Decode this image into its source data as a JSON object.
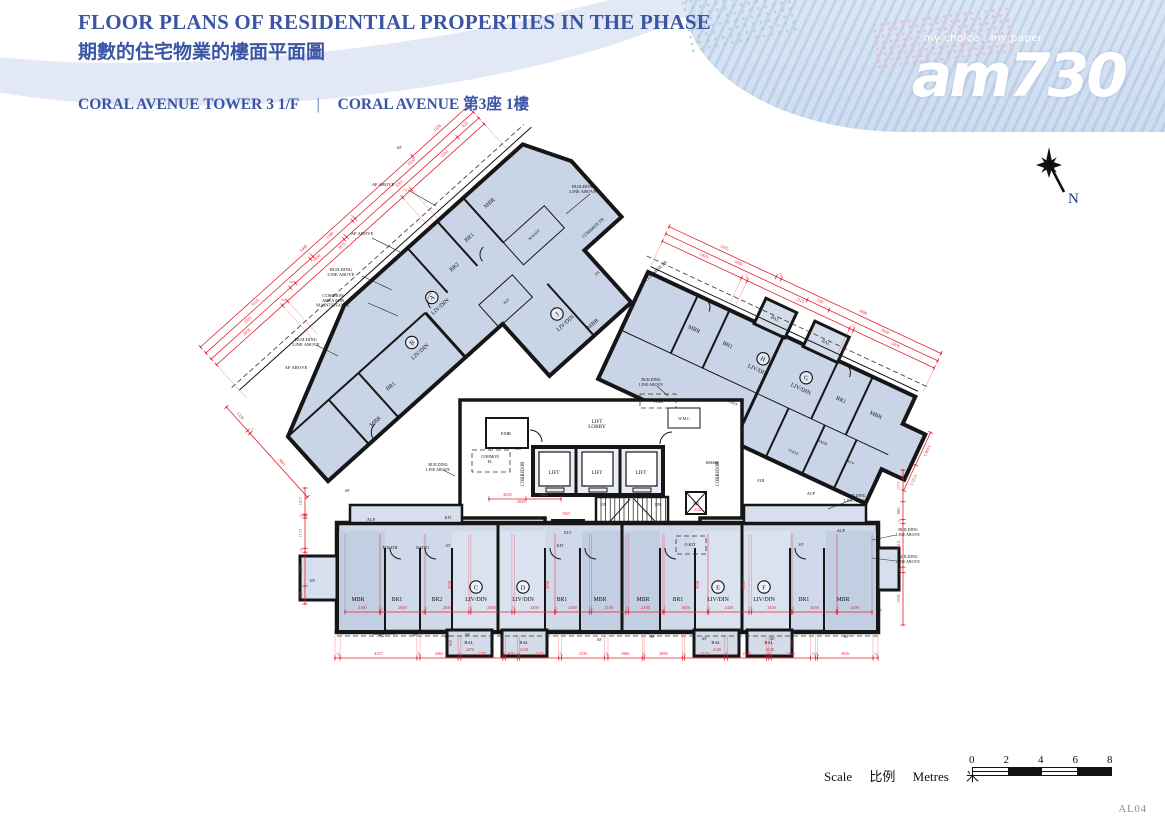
{
  "theme": {
    "accent": "#3a55a4",
    "red": "#e5202e",
    "wall": "#161616",
    "unit_fill": "#c9d4e6"
  },
  "header": {
    "title_en": "FLOOR PLANS OF RESIDENTIAL PROPERTIES IN THE PHASE",
    "title_zh": "期數的住宅物業的樓面平面圖",
    "subtitle_en": "CORAL AVENUE TOWER 3  1/F",
    "separator": "|",
    "subtitle_name": "CORAL AVENUE",
    "subtitle_zh": "第3座 1樓"
  },
  "logo": {
    "tagline": "my choice : my paper",
    "name": "am730"
  },
  "compass": {
    "n": "N"
  },
  "scalebar": {
    "scale_en": "Scale",
    "scale_zh": "比例",
    "metres_en": "Metres",
    "metres_zh": "米",
    "ticks": [
      "0",
      "2",
      "4",
      "6",
      "8"
    ]
  },
  "footer": {
    "code": "AL04"
  },
  "plan": {
    "labels": [
      {
        "t": "C",
        "x": 476,
        "y": 587,
        "c": "circ"
      },
      {
        "t": "D",
        "x": 523,
        "y": 587,
        "c": "circ"
      },
      {
        "t": "E",
        "x": 718,
        "y": 587,
        "c": "circ"
      },
      {
        "t": "F",
        "x": 764,
        "y": 587,
        "c": "circ"
      },
      {
        "t": "MBR",
        "x": 358,
        "y": 601,
        "c": "room"
      },
      {
        "t": "BR1",
        "x": 397,
        "y": 601,
        "c": "room"
      },
      {
        "t": "BR2",
        "x": 437,
        "y": 601,
        "c": "room"
      },
      {
        "t": "LIV/DIN",
        "x": 476,
        "y": 601,
        "c": "room"
      },
      {
        "t": "LIV/DIN",
        "x": 523,
        "y": 601,
        "c": "room"
      },
      {
        "t": "BR1",
        "x": 562,
        "y": 601,
        "c": "room"
      },
      {
        "t": "MBR",
        "x": 600,
        "y": 601,
        "c": "room"
      },
      {
        "t": "MBR",
        "x": 643,
        "y": 601,
        "c": "room"
      },
      {
        "t": "BR1",
        "x": 678,
        "y": 601,
        "c": "room"
      },
      {
        "t": "LIV/DIN",
        "x": 718,
        "y": 601,
        "c": "room"
      },
      {
        "t": "LIV/DIN",
        "x": 764,
        "y": 601,
        "c": "room"
      },
      {
        "t": "BR1",
        "x": 804,
        "y": 601,
        "c": "room"
      },
      {
        "t": "MBR",
        "x": 843,
        "y": 601,
        "c": "room"
      },
      {
        "t": "BAL",
        "x": 469,
        "y": 644,
        "c": "sm",
        "s": 4.6
      },
      {
        "t": "BAL",
        "x": 524,
        "y": 644,
        "c": "sm",
        "s": 4.6
      },
      {
        "t": "BAL",
        "x": 716,
        "y": 644,
        "c": "sm",
        "s": 4.6
      },
      {
        "t": "BAL",
        "x": 769,
        "y": 644,
        "c": "sm",
        "s": 4.6
      },
      {
        "t": "UP",
        "x": 312,
        "y": 582,
        "c": "sm"
      },
      {
        "t": "LIFT",
        "x": 554,
        "y": 474,
        "c": "room",
        "s": 5.2
      },
      {
        "t": "LIFT",
        "x": 597,
        "y": 474,
        "c": "room",
        "s": 5.2
      },
      {
        "t": "LIFT",
        "x": 641,
        "y": 474,
        "c": "room",
        "s": 5.2
      },
      {
        "t": "LIFT\nLOBBY",
        "x": 597,
        "y": 423,
        "c": "room",
        "s": 5.2
      },
      {
        "t": "CORRIDOR",
        "x": 524,
        "y": 474,
        "c": "sm",
        "s": 4.8,
        "r": -90
      },
      {
        "t": "CORRIDOR",
        "x": 719,
        "y": 474,
        "c": "sm",
        "s": 4.8,
        "r": -90
      },
      {
        "t": "EMR",
        "x": 506,
        "y": 435,
        "c": "sm",
        "s": 4.6
      },
      {
        "t": "COMMON\nEL",
        "x": 490,
        "y": 458,
        "c": "sm",
        "s": 3.9
      },
      {
        "t": "ELV",
        "x": 568,
        "y": 534,
        "c": "sm",
        "s": 4.2
      },
      {
        "t": "UP",
        "x": 603,
        "y": 506,
        "c": "sm",
        "s": 4.2
      },
      {
        "t": "DN",
        "x": 658,
        "y": 506,
        "c": "sm",
        "s": 4.2
      },
      {
        "t": "PD",
        "x": 696,
        "y": 505,
        "c": "sm",
        "s": 4.4
      },
      {
        "t": "RS&MR",
        "x": 712,
        "y": 464,
        "c": "sm",
        "s": 3.6
      },
      {
        "t": "ELR",
        "x": 761,
        "y": 482,
        "c": "sm",
        "s": 3.8
      },
      {
        "t": "W.M.C",
        "x": 684,
        "y": 420,
        "c": "sm",
        "s": 4
      },
      {
        "t": "VOID",
        "x": 658,
        "y": 403,
        "c": "sm",
        "s": 4.2
      },
      {
        "t": "DH",
        "x": 518,
        "y": 450,
        "c": "sm",
        "s": 3.8
      },
      {
        "t": "ACP",
        "x": 371,
        "y": 521,
        "c": "sm"
      },
      {
        "t": "KIT",
        "x": 448,
        "y": 519,
        "c": "sm"
      },
      {
        "t": "M.BATH",
        "x": 390,
        "y": 549,
        "c": "sm",
        "s": 4
      },
      {
        "t": "BATH 1",
        "x": 423,
        "y": 549,
        "c": "sm",
        "s": 4
      },
      {
        "t": "ST",
        "x": 448,
        "y": 547,
        "c": "sm",
        "s": 4
      },
      {
        "t": "KIT",
        "x": 560,
        "y": 547,
        "c": "sm"
      },
      {
        "t": "O.KIT",
        "x": 690,
        "y": 546,
        "c": "sm"
      },
      {
        "t": "ST",
        "x": 801,
        "y": 546,
        "c": "sm"
      },
      {
        "t": "ACP",
        "x": 841,
        "y": 532,
        "c": "sm"
      },
      {
        "t": "ACP",
        "x": 811,
        "y": 495,
        "c": "sm"
      },
      {
        "t": "AF",
        "x": 399,
        "y": 149,
        "c": "ann",
        "s": 4
      },
      {
        "t": "AF ABOVE",
        "x": 383,
        "y": 186,
        "c": "ann"
      },
      {
        "t": "AF ABOVE",
        "x": 362,
        "y": 235,
        "c": "ann"
      },
      {
        "t": "BUILDING\nLINE ABOVE",
        "x": 341,
        "y": 271,
        "c": "ann"
      },
      {
        "t": "COMMON\nAREA FOR\nMAINTENANCE",
        "x": 333,
        "y": 297,
        "c": "ann"
      },
      {
        "t": "BUILDING\nLINE ABOVE",
        "x": 306,
        "y": 341,
        "c": "ann"
      },
      {
        "t": "AF ABOVE",
        "x": 296,
        "y": 369,
        "c": "ann"
      },
      {
        "t": "BUILDING\nLINE ABOVE",
        "x": 583,
        "y": 188,
        "c": "ann"
      },
      {
        "t": "COMMON FR",
        "x": 594,
        "y": 229,
        "c": "ann",
        "r": -42
      },
      {
        "t": "COMMON FR",
        "x": 657,
        "y": 272,
        "c": "ann",
        "r": -42
      },
      {
        "t": "BUILDING\nLINE ABOVE",
        "x": 651,
        "y": 381,
        "c": "ann",
        "s": 4
      },
      {
        "t": "BUILDING\nLINE ABOVE",
        "x": 438,
        "y": 466,
        "c": "ann",
        "s": 4
      },
      {
        "t": "BUILDING\nLINE ABOVE",
        "x": 856,
        "y": 497,
        "c": "ann",
        "s": 4
      },
      {
        "t": "BUILDING\nLINE ABOVE",
        "x": 908,
        "y": 531,
        "c": "ann",
        "s": 4
      },
      {
        "t": "BUILDING\nLINE ABOVE",
        "x": 908,
        "y": 558,
        "c": "ann",
        "s": 4
      },
      {
        "t": "AF ABOVE",
        "x": 384,
        "y": 635,
        "c": "ann"
      },
      {
        "t": "AF",
        "x": 336,
        "y": 633,
        "c": "ann",
        "s": 4
      },
      {
        "t": "AF",
        "x": 415,
        "y": 636,
        "c": "ann",
        "s": 4
      },
      {
        "t": "AF",
        "x": 447,
        "y": 638,
        "c": "ann",
        "s": 4
      },
      {
        "t": "AF",
        "x": 467,
        "y": 636,
        "c": "ann",
        "s": 4
      },
      {
        "t": "AF",
        "x": 599,
        "y": 641,
        "c": "ann",
        "s": 4
      },
      {
        "t": "AF",
        "x": 652,
        "y": 638,
        "c": "ann",
        "s": 4
      },
      {
        "t": "AF",
        "x": 704,
        "y": 640,
        "c": "ann",
        "s": 4
      },
      {
        "t": "AF",
        "x": 772,
        "y": 640,
        "c": "ann",
        "s": 4
      },
      {
        "t": "AF",
        "x": 846,
        "y": 638,
        "c": "ann",
        "s": 4
      },
      {
        "t": "AF",
        "x": 305,
        "y": 517,
        "c": "ann",
        "s": 4
      },
      {
        "t": "AF",
        "x": 347,
        "y": 492,
        "c": "ann",
        "s": 4
      },
      {
        "t": "AF",
        "x": 879,
        "y": 612,
        "c": "ann",
        "s": 4
      },
      {
        "t": "2470",
        "x": 470,
        "y": 651,
        "c": "red"
      },
      {
        "t": "2120",
        "x": 524,
        "y": 651,
        "c": "red"
      },
      {
        "t": "2120",
        "x": 717,
        "y": 651,
        "c": "red"
      },
      {
        "t": "2126",
        "x": 770,
        "y": 651,
        "c": "red"
      },
      {
        "t": "2035",
        "x": 521,
        "y": 503,
        "c": "red"
      },
      {
        "t": "1925",
        "x": 566,
        "y": 515,
        "c": "red"
      },
      {
        "t": "2128",
        "x": 698,
        "y": 511,
        "c": "red"
      },
      {
        "t": "3150",
        "x": 451,
        "y": 585,
        "c": "vred"
      },
      {
        "t": "3150",
        "x": 549,
        "y": 585,
        "c": "vred"
      },
      {
        "t": "3150",
        "x": 699,
        "y": 585,
        "c": "vred"
      },
      {
        "t": "3150",
        "x": 745,
        "y": 585,
        "c": "vred"
      },
      {
        "t": "850",
        "x": 452,
        "y": 643,
        "c": "vred"
      },
      {
        "t": "850",
        "x": 794,
        "y": 643,
        "c": "vred"
      },
      {
        "g": "ab",
        "t": "A",
        "x": 518,
        "y": 418,
        "c": "circ"
      },
      {
        "g": "ab",
        "t": "LIV/DIN",
        "x": 518,
        "y": 432,
        "c": "room"
      },
      {
        "g": "ab",
        "t": "MBR",
        "x": 624,
        "y": 388,
        "c": "room"
      },
      {
        "g": "ab",
        "t": "BR1",
        "x": 586,
        "y": 400,
        "c": "room"
      },
      {
        "g": "ab",
        "t": "BR2",
        "x": 555,
        "y": 412,
        "c": "room"
      },
      {
        "g": "ab",
        "t": "M.BATH",
        "x": 636,
        "y": 441,
        "c": "sm",
        "s": 3.8
      },
      {
        "g": "ab",
        "t": "KIT",
        "x": 571,
        "y": 472,
        "c": "sm",
        "s": 4
      },
      {
        "g": "ab",
        "t": "B",
        "x": 473,
        "y": 438,
        "c": "circ"
      },
      {
        "g": "ab",
        "t": "LIV/DIN",
        "x": 473,
        "y": 452,
        "c": "room"
      },
      {
        "g": "ab",
        "t": "BR1",
        "x": 428,
        "y": 458,
        "c": "room"
      },
      {
        "g": "ab",
        "t": "MBR",
        "x": 393,
        "y": 474,
        "c": "room"
      },
      {
        "g": "ab",
        "t": "J",
        "x": 600,
        "y": 514,
        "c": "circ"
      },
      {
        "g": "ab",
        "t": "LIV/DIN",
        "x": 600,
        "y": 528,
        "c": "room"
      },
      {
        "g": "ab",
        "t": "MBR",
        "x": 620,
        "y": 547,
        "c": "room"
      },
      {
        "g": "ab",
        "t": "FR",
        "x": 657,
        "y": 512,
        "c": "sm",
        "s": 4
      },
      {
        "g": "hg",
        "t": "H",
        "x": 789,
        "y": 302,
        "c": "circ"
      },
      {
        "g": "hg",
        "t": "LIV/DIN",
        "x": 789,
        "y": 316,
        "c": "room"
      },
      {
        "g": "hg",
        "t": "MBR",
        "x": 714,
        "y": 306,
        "c": "room"
      },
      {
        "g": "hg",
        "t": "BR1",
        "x": 751,
        "y": 306,
        "c": "room"
      },
      {
        "g": "hg",
        "t": "O.KIT",
        "x": 780,
        "y": 356,
        "c": "sm",
        "s": 4
      },
      {
        "g": "hg",
        "t": "BAL",
        "x": 783,
        "y": 262,
        "c": "sm",
        "s": 4.4
      },
      {
        "g": "hg",
        "t": "BAL",
        "x": 839,
        "y": 262,
        "c": "sm",
        "s": 4.4
      },
      {
        "g": "hg",
        "t": "G",
        "x": 836,
        "y": 301,
        "c": "circ"
      },
      {
        "g": "hg",
        "t": "LIV/DIN",
        "x": 836,
        "y": 315,
        "c": "room"
      },
      {
        "g": "hg",
        "t": "BR1",
        "x": 877,
        "y": 308,
        "c": "room"
      },
      {
        "g": "hg",
        "t": "MBR",
        "x": 915,
        "y": 307,
        "c": "room"
      },
      {
        "g": "hg",
        "t": "BATH",
        "x": 878,
        "y": 354,
        "c": "sm",
        "s": 4
      },
      {
        "g": "hg",
        "t": "O.KIT",
        "x": 856,
        "y": 375,
        "c": "sm",
        "s": 4
      },
      {
        "g": "hg",
        "t": "ACP",
        "x": 912,
        "y": 360,
        "c": "sm",
        "s": 3.8
      }
    ],
    "dims": [
      {
        "x1": 335,
        "y1": 658,
        "x2": 878,
        "y2": 658,
        "e": -22,
        "v": [
          278,
          4157,
          168,
          2065,
          150,
          2275,
          125,
          650,
          125,
          2125,
          150,
          2335,
          180,
          1860,
          100,
          2080,
          100,
          2175,
          150,
          2125,
          125,
          125,
          2125,
          275,
          100,
          3016,
          270
        ]
      },
      {
        "x1": 345,
        "y1": 612,
        "x2": 872,
        "y2": 612,
        "e": -78,
        "v": [
          2100,
          75,
          2650,
          75,
          2650,
          125,
          2500,
          150,
          2450,
          75,
          2050,
          125,
          2100,
          150,
          2100,
          75,
          2650,
          75,
          2450,
          150,
          2450,
          75,
          2650,
          75,
          2100
        ]
      },
      {
        "x1": 305,
        "y1": 604,
        "x2": 305,
        "y2": 488,
        "v": [
          700,
          1310,
          150,
          1173,
          150,
          1017
        ]
      },
      {
        "x1": 903,
        "y1": 625,
        "x2": 903,
        "y2": 470,
        "v": [
          1938,
          200,
          1610,
          150,
          660,
          1173
        ]
      },
      {
        "x1": 489,
        "y1": 499,
        "x2": 561,
        "y2": 499,
        "v": [
          2035,
          1925
        ]
      },
      {
        "g": "ab",
        "x1": 313,
        "y1": 300,
        "x2": 673,
        "y2": 300,
        "v": [
          5448,
          1430
        ]
      },
      {
        "g": "ab",
        "x1": 313,
        "y1": 308,
        "x2": 673,
        "y2": 308,
        "v": [
          3110,
          75,
          1180,
          75,
          3520
        ]
      },
      {
        "g": "ab",
        "x1": 313,
        "y1": 316,
        "x2": 673,
        "y2": 316,
        "v": [
          2325,
          150,
          1430,
          75,
          3261,
          625
        ]
      },
      {
        "g": "ab",
        "x1": 313,
        "y1": 324,
        "x2": 673,
        "y2": 324,
        "e": 45,
        "v": [
          2050,
          150,
          3575,
          275,
          2261
        ]
      },
      {
        "g": "ab",
        "x1": 292,
        "y1": 362,
        "x2": 292,
        "y2": 483,
        "v": [
          1330,
          150,
          3601
        ]
      },
      {
        "g": "hg",
        "x1": 648,
        "y1": 222,
        "x2": 948,
        "y2": 222,
        "v": [
          2475,
          118,
          3690
        ]
      },
      {
        "g": "hg",
        "x1": 648,
        "y1": 230,
        "x2": 948,
        "y2": 230,
        "v": [
          3450,
          528,
          2650
        ]
      },
      {
        "g": "hg",
        "x1": 648,
        "y1": 238,
        "x2": 948,
        "y2": 238,
        "e": 26,
        "v": [
          2420,
          176,
          3125,
          125,
          2470
        ]
      },
      {
        "g": "hg",
        "x1": 972,
        "y1": 298,
        "x2": 972,
        "y2": 362,
        "v": [
          1438.5,
          1125.5
        ]
      }
    ]
  }
}
